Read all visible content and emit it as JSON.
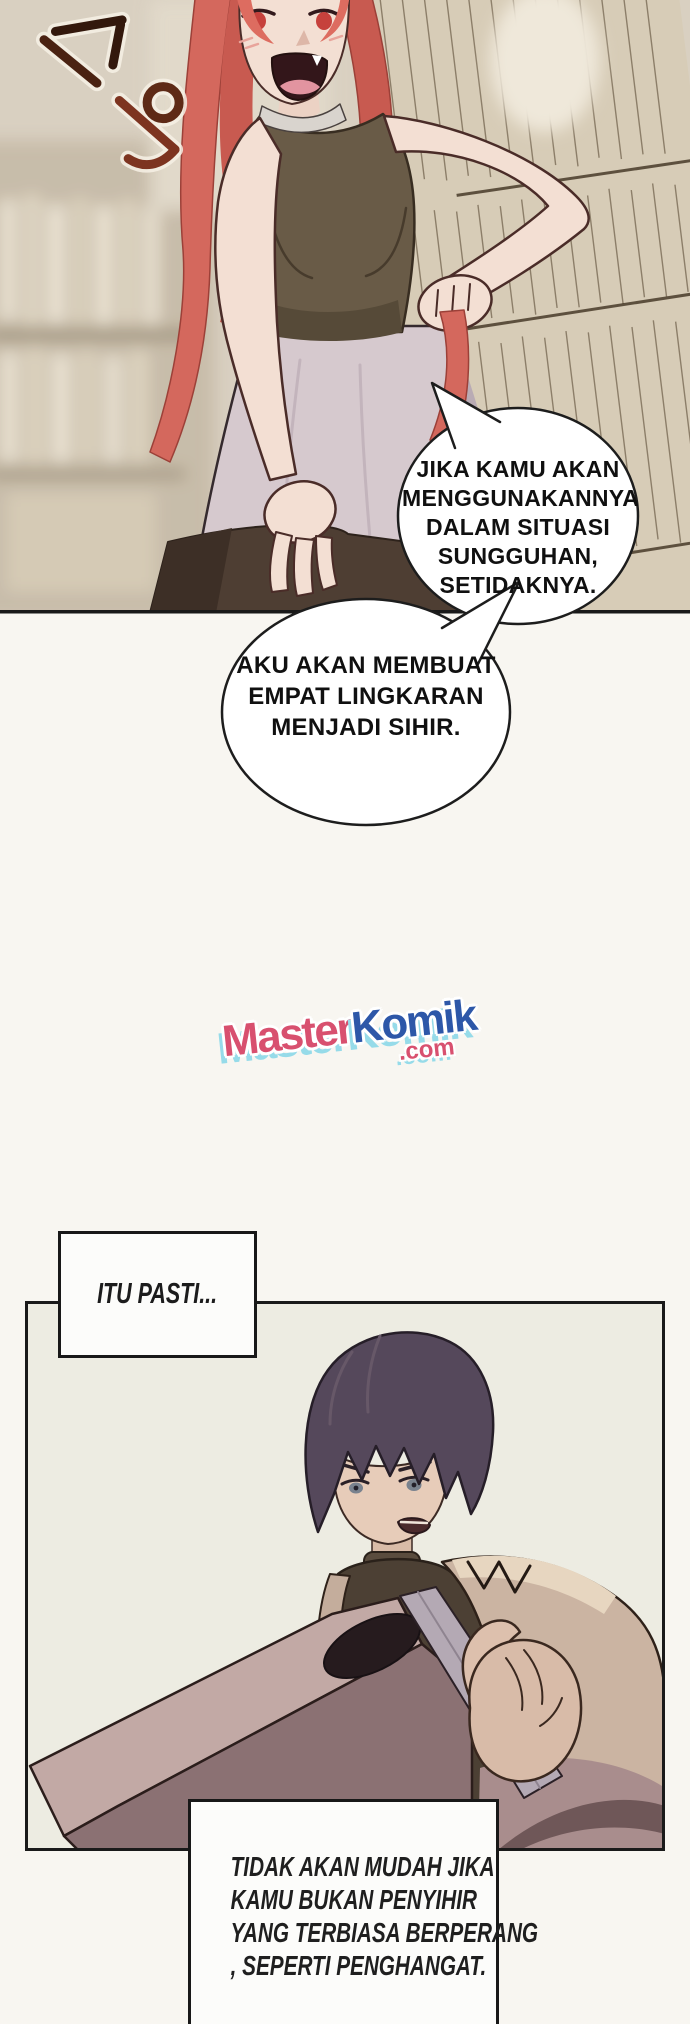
{
  "page": {
    "width": 690,
    "height": 2024,
    "background": "#f8f6f1"
  },
  "panel1": {
    "sfx": "스윽",
    "speech_bubbles": [
      {
        "lines": [
          "JIKA KAMU AKAN",
          "MENGGUNAKANNYA",
          "DALAM SITUASI",
          "SUNGGUHAN,",
          "SETIDAKNYA."
        ]
      },
      {
        "lines": [
          "AKU AKAN MEMBUAT",
          "EMPAT LINGKARAN",
          "MENJADI SIHIR."
        ]
      }
    ]
  },
  "watermark": {
    "master": "Master",
    "komik": "Komik",
    "dotcom": ".com",
    "master_color": "#d8506f",
    "komik_color": "#2d57a8",
    "shadow_color": "#96dbe9"
  },
  "panel2": {
    "caption": "ITU PASTI...",
    "narration_lines": [
      "TIDAK AKAN MUDAH JIKA",
      "KAMU BUKAN PENYIHIR",
      "YANG TERBIASA BERPERANG",
      ", SEPERTI PENGHANGAT."
    ]
  }
}
